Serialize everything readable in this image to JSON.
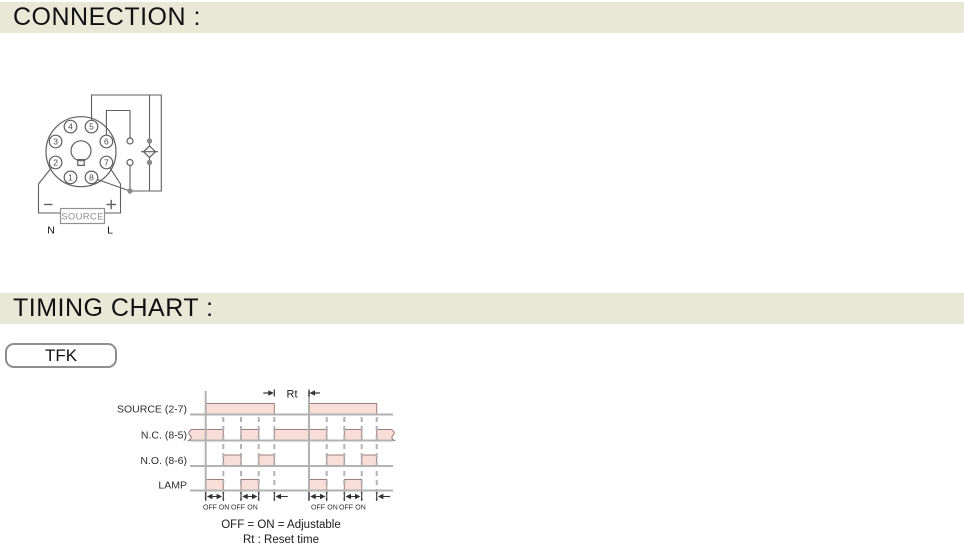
{
  "colors": {
    "bar_bg": "#e9e7d6",
    "pulse_fill": "#f9ded8",
    "pulse_stroke": "#9c7e7c",
    "grid": "#b2b2b2",
    "ink": "#333333",
    "wire": "#5f5f5f",
    "muted": "#8d8d8d"
  },
  "sections": {
    "connection_title": "CONNECTION :",
    "timing_title": "TIMING CHART :"
  },
  "timing_model": {
    "label": "TFK"
  },
  "connection": {
    "pins": [
      "1",
      "2",
      "3",
      "4",
      "5",
      "6",
      "7",
      "8"
    ],
    "source_label": "SOURCE",
    "minus_label": "−",
    "plus_label": "+",
    "neutral_label": "N",
    "line_label": "L"
  },
  "timing": {
    "chart": {
      "left_x": 190,
      "right_x": 393,
      "label_x": 187,
      "pulse_height": 11,
      "top_y": 391,
      "bottom_y": 500
    },
    "rows": [
      {
        "label": "SOURCE  (2-7)",
        "baseline": 414.5,
        "pulses": [
          [
            205.7,
            274.3
          ],
          [
            309,
            376.7
          ]
        ]
      },
      {
        "label": "N.C.  (8-5)",
        "baseline": 440.5,
        "pulses": [
          [
            190.5,
            223.3
          ],
          [
            241,
            258.7
          ],
          [
            274.3,
            326.7
          ],
          [
            344.3,
            361.7
          ],
          [
            376.7,
            392.5
          ]
        ],
        "break_left": true,
        "break_right": true
      },
      {
        "label": "N.O.  (8-6)",
        "baseline": 466,
        "pulses": [
          [
            223.3,
            241
          ],
          [
            258.7,
            274.3
          ],
          [
            326.7,
            344.3
          ],
          [
            361.7,
            376.7
          ]
        ]
      },
      {
        "label": "LAMP",
        "baseline": 490.5,
        "pulses": [
          [
            205.7,
            223.3
          ],
          [
            241,
            258.7
          ],
          [
            309,
            326.7
          ],
          [
            344.3,
            361.7
          ]
        ]
      }
    ],
    "solid_lines": [
      205.7,
      309
    ],
    "dashed_lines": [
      223.3,
      241,
      258.7,
      274.3,
      326.7,
      344.3,
      361.7,
      376.7
    ],
    "rt": {
      "label": "Rt",
      "label_x": 292,
      "label_y": 397.5,
      "tick_left": 274.3,
      "tick_right": 309,
      "arrow_y": 393,
      "arrow_len": 11
    },
    "bottom": {
      "ticks": [
        205.7,
        223.3,
        241,
        258.7,
        274.3,
        309,
        326.7,
        344.3,
        361.7,
        376.7
      ],
      "span_arrows": [
        [
          205.7,
          223.3
        ],
        [
          241,
          258.7
        ],
        [
          309,
          326.7
        ],
        [
          344.3,
          361.7
        ]
      ],
      "tail_arrows": [
        274.3,
        376.7
      ],
      "labels": [
        {
          "text": "OFF",
          "x": 210
        },
        {
          "text": "ON",
          "x": 224
        },
        {
          "text": "OFF",
          "x": 238
        },
        {
          "text": "ON",
          "x": 252.5
        },
        {
          "text": "OFF",
          "x": 318
        },
        {
          "text": "ON",
          "x": 332.5
        },
        {
          "text": "OFF",
          "x": 346
        },
        {
          "text": "ON",
          "x": 360.5
        }
      ]
    },
    "notes": [
      "OFF = ON = Adjustable",
      "Rt : Reset time"
    ]
  }
}
